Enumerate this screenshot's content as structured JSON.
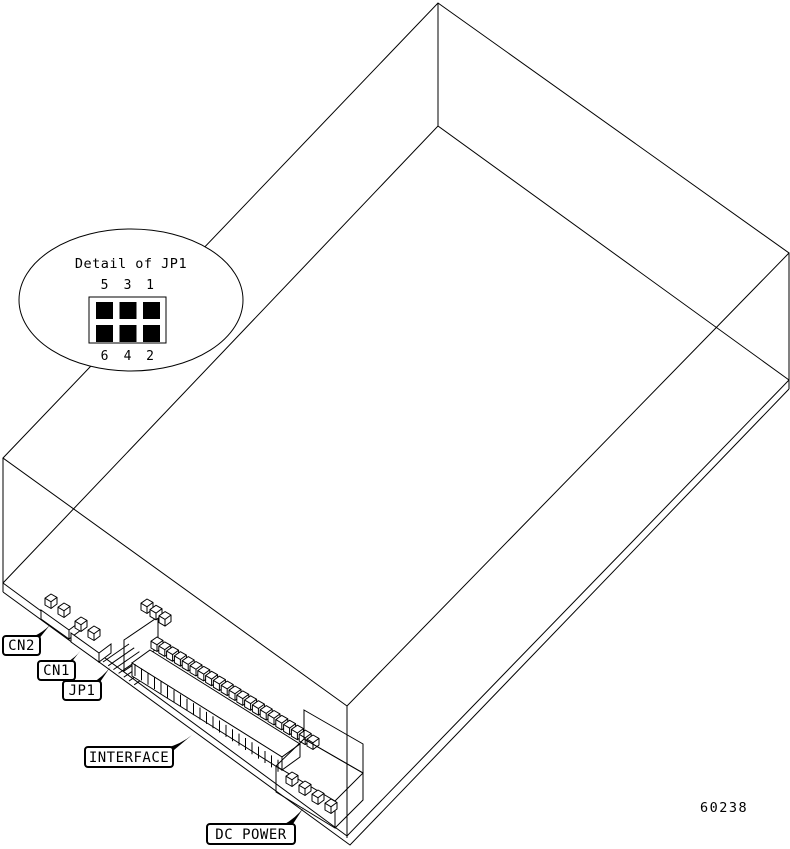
{
  "figure_number": "60238",
  "colors": {
    "line": "#000000",
    "background": "#ffffff"
  },
  "detail_bubble": {
    "title": "Detail of JP1",
    "top_pin_labels": [
      "5",
      "3",
      "1"
    ],
    "bottom_pin_labels": [
      "6",
      "4",
      "2"
    ],
    "jumper": {
      "rows": 2,
      "cols": 3
    }
  },
  "callouts": {
    "cn2": {
      "label": "CN2"
    },
    "cn1": {
      "label": "CN1"
    },
    "jp1": {
      "label": "JP1"
    },
    "interface": {
      "label": "INTERFACE"
    },
    "dc_power": {
      "label": "DC POWER"
    }
  }
}
